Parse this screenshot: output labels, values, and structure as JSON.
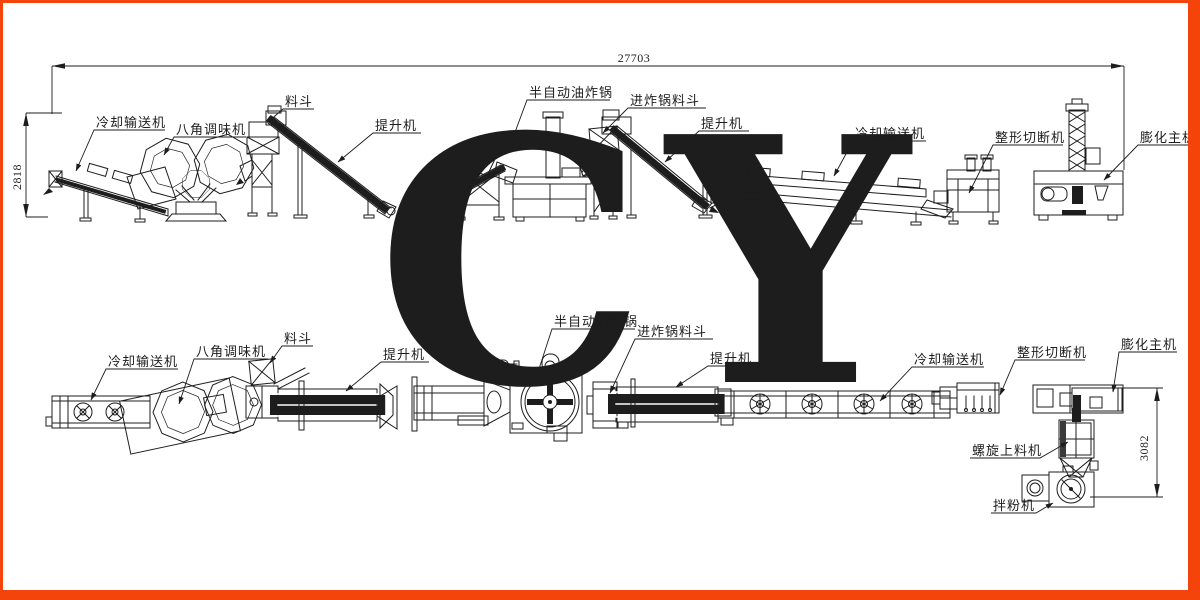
{
  "page": {
    "frame_color": "#f4430b",
    "background": "#ffffff"
  },
  "watermark": {
    "text": "CY",
    "color": "#f3a29b"
  },
  "drawing": {
    "line_color": "#1d1d1d"
  },
  "dimensions": {
    "overall_length": "27703",
    "elevation_height": "2818",
    "plan_depth": "3082"
  },
  "elevation": {
    "labels": [
      {
        "text": "冷却输送机"
      },
      {
        "text": "八角调味机"
      },
      {
        "text": "料斗"
      },
      {
        "text": "提升机"
      },
      {
        "text": "半自动油炸锅"
      },
      {
        "text": "进炸锅料斗"
      },
      {
        "text": "提升机"
      },
      {
        "text": "冷却输送机"
      },
      {
        "text": "整形切断机"
      },
      {
        "text": "膨化主机"
      }
    ]
  },
  "plan": {
    "labels": [
      {
        "text": "冷却输送机"
      },
      {
        "text": "八角调味机"
      },
      {
        "text": "料斗"
      },
      {
        "text": "提升机"
      },
      {
        "text": "半自动油炸锅"
      },
      {
        "text": "进炸锅料斗"
      },
      {
        "text": "提升机"
      },
      {
        "text": "冷却输送机"
      },
      {
        "text": "整形切断机"
      },
      {
        "text": "膨化主机"
      },
      {
        "text": "螺旋上料机"
      },
      {
        "text": "拌粉机"
      }
    ]
  }
}
